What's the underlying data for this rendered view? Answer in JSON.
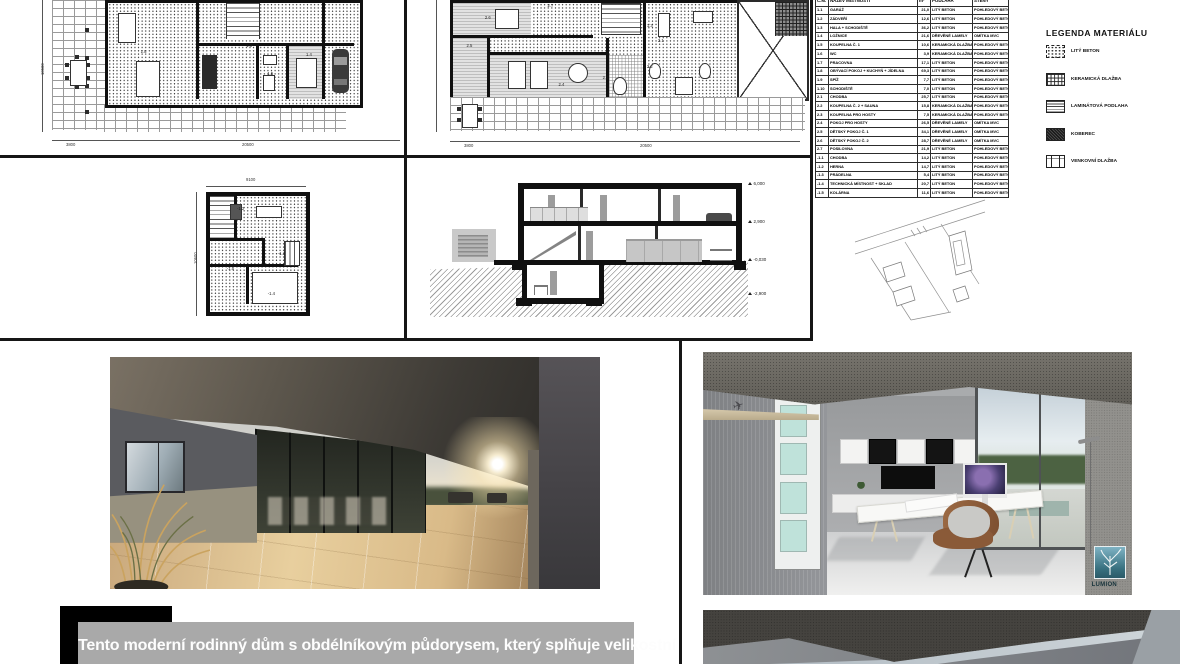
{
  "table": {
    "headers": [
      "Č.M.",
      "NÁZEV MÍSTNOSTI",
      "m²",
      "PODLAHA",
      "STĚNY"
    ],
    "rows": [
      [
        "1.1",
        "GARÁŽ",
        "21,0",
        "LITÝ BETON",
        "POHLEDOVÝ BETON"
      ],
      [
        "1.2",
        "ZÁDVEŘÍ",
        "12,6",
        "LITÝ BETON",
        "POHLEDOVÝ BETON"
      ],
      [
        "1.3",
        "HALA + SCHODIŠTĚ",
        "36,2",
        "LITÝ BETON",
        "POHLEDOVÝ BETON"
      ],
      [
        "1.4",
        "LOŽNICE",
        "21,6",
        "DŘEVĚNÉ LAMELY",
        "OMÍTKA MVC"
      ],
      [
        "1.5",
        "KOUPELNA Č. 1",
        "10,6",
        "KERAMICKÁ DLAŽBA",
        "POHLEDOVÝ BETON"
      ],
      [
        "1.6",
        "WC",
        "3,9",
        "KERAMICKÁ DLAŽBA",
        "POHLEDOVÝ BETON"
      ],
      [
        "1.7",
        "PRACOVNA",
        "17,1",
        "LITÝ BETON",
        "POHLEDOVÝ BETON"
      ],
      [
        "1.8",
        "OBÝVACÍ POKOJ + KUCHYŇ + JÍDELNA",
        "69,3",
        "LITÝ BETON",
        "POHLEDOVÝ BETON"
      ],
      [
        "1.9",
        "SPÍŽ",
        "7,7",
        "LITÝ BETON",
        "POHLEDOVÝ BETON"
      ],
      [
        "1.10",
        "SCHODIŠTĚ",
        "7,0",
        "LITÝ BETON",
        "POHLEDOVÝ BETON"
      ],
      [
        "2.1",
        "CHODBA",
        "25,7",
        "LITÝ BETON",
        "POHLEDOVÝ BETON"
      ],
      [
        "2.2",
        "KOUPELNA Č. 2 + SAUNA",
        "15,8",
        "KERAMICKÁ DLAŽBA",
        "POHLEDOVÝ BETON"
      ],
      [
        "2.3",
        "KOUPELNA PRO HOSTY",
        "7,5",
        "KERAMICKÁ DLAŽBA",
        "POHLEDOVÝ BETON"
      ],
      [
        "2.4",
        "POKOJ PRO HOSTY",
        "26,5",
        "DŘEVĚNÉ LAMELY",
        "OMÍTKA MVC"
      ],
      [
        "2.5",
        "DĚTSKÝ POKOJ Č. 1",
        "34,1",
        "DŘEVĚNÉ LAMELY",
        "OMÍTKA MVC"
      ],
      [
        "2.6",
        "DĚTSKÝ POKOJ Č. 2",
        "28,7",
        "DŘEVĚNÉ LAMELY",
        "OMÍTKA MVC"
      ],
      [
        "2.7",
        "POSILOVNA",
        "21,9",
        "LITÝ BETON",
        "POHLEDOVÝ BETON"
      ],
      [
        "-1.1",
        "CHODBA",
        "14,2",
        "LITÝ BETON",
        "POHLEDOVÝ BETON"
      ],
      [
        "-1.2",
        "HERNA",
        "14,7",
        "LITÝ BETON",
        "POHLEDOVÝ BETON"
      ],
      [
        "-1.3",
        "PRÁDELNA",
        "5,4",
        "LITÝ BETON",
        "POHLEDOVÝ BETON"
      ],
      [
        "-1.4",
        "TECHNICKÁ MÍSTNOST + SKLAD",
        "20,7",
        "LITÝ BETON",
        "POHLEDOVÝ BETON"
      ],
      [
        "-1.5",
        "KOLÁRNA",
        "11,6",
        "LITÝ BETON",
        "POHLEDOVÝ BETON"
      ]
    ]
  },
  "legend": {
    "title": "LEGENDA MATERIÁLU",
    "items": [
      {
        "label": "LITÝ BETON",
        "pattern": "dots"
      },
      {
        "label": "KERAMICKÁ DLAŽBA",
        "pattern": "grid"
      },
      {
        "label": "LAMINÁTOVÁ PODLAHA",
        "pattern": "stripes"
      },
      {
        "label": "KOBEREC",
        "pattern": "carpet"
      },
      {
        "label": "VENKOVNÍ DLAŽBA",
        "pattern": "tile"
      }
    ]
  },
  "plans": {
    "ground": {
      "labels": [
        {
          "t": "1.8",
          "x": 26,
          "y": 34
        },
        {
          "t": "1.3",
          "x": 56,
          "y": 30
        },
        {
          "t": "1.4",
          "x": 73,
          "y": 36
        },
        {
          "t": "1.5",
          "x": 62,
          "y": 49
        }
      ],
      "dims": {
        "bottom_left": "3800",
        "bottom_right": "20500",
        "left": "10500"
      }
    },
    "upper": {
      "labels": [
        {
          "t": "2.6",
          "x": 13,
          "y": 12
        },
        {
          "t": "2.5",
          "x": 8,
          "y": 30
        },
        {
          "t": "2.7",
          "x": 30,
          "y": 4
        },
        {
          "t": "2.4",
          "x": 33,
          "y": 56
        },
        {
          "t": "2.3",
          "x": 45,
          "y": 51
        },
        {
          "t": "2.2",
          "x": 57,
          "y": 44
        },
        {
          "t": "2.1",
          "x": 60,
          "y": 27
        },
        {
          "t": "1.3",
          "x": 57,
          "y": 17
        }
      ],
      "dims": {
        "bottom_left": "3800",
        "bottom_right": "20500"
      }
    },
    "basement": {
      "labels": [
        {
          "t": "-1.2",
          "x": 38,
          "y": 22
        },
        {
          "t": "-1.1",
          "x": 54,
          "y": 43
        },
        {
          "t": "-1.3",
          "x": 70,
          "y": 53
        },
        {
          "t": "-1.5",
          "x": 30,
          "y": 63
        },
        {
          "t": "-1.4",
          "x": 62,
          "y": 80
        }
      ],
      "dims": {
        "top": "9100",
        "left": "10600"
      }
    }
  },
  "section": {
    "levels": [
      "6,000",
      "2,900",
      "-0,030",
      "-2,900"
    ]
  },
  "description": "Tento moderní rodinný dům s obdélníkovým půdorysem, který splňuje velikostní",
  "watermark": "LUMION",
  "colors": {
    "line_black": "#101010",
    "lumion_teal": "#38707f",
    "desc_gray": "#a9a9a9"
  }
}
